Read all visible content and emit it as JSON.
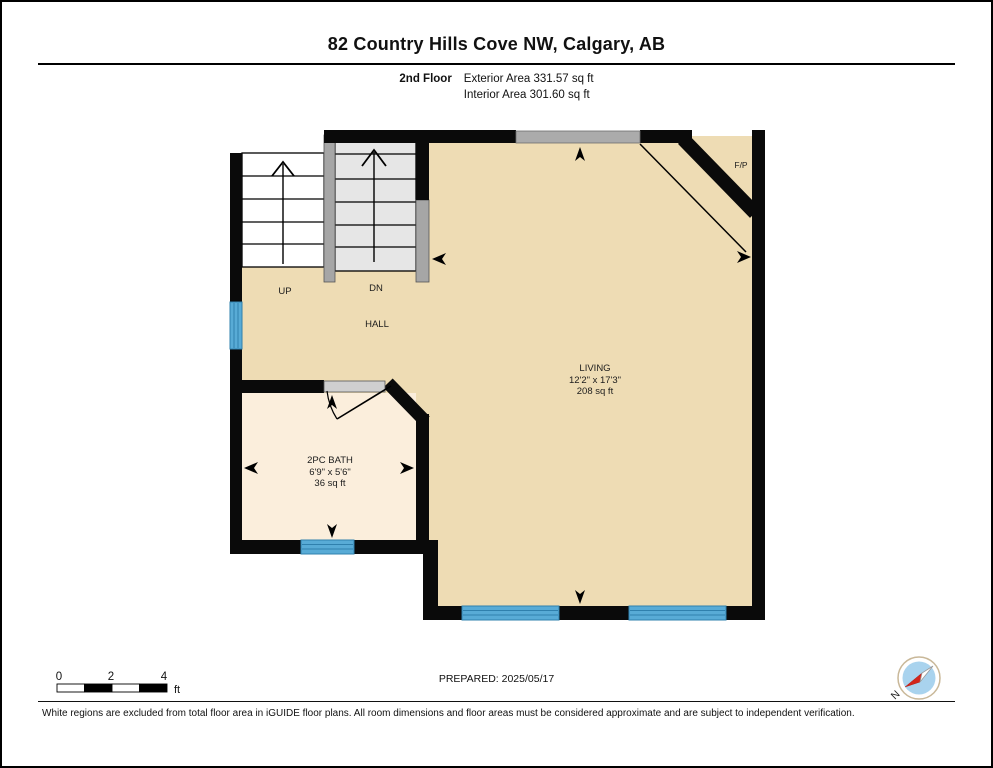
{
  "header": {
    "title": "82 Country Hills Cove NW, Calgary, AB",
    "floor_label": "2nd Floor",
    "exterior_area": "Exterior Area 331.57 sq ft",
    "interior_area": "Interior Area 301.60 sq ft"
  },
  "plan": {
    "labels": {
      "stairs_up": "UP",
      "stairs_down": "DN",
      "hall": "HALL",
      "fireplace": "F/P",
      "living": {
        "name": "LIVING",
        "dimensions": "12'2\" x 17'3\"",
        "area": "208 sq ft"
      },
      "bath": {
        "name": "2PC BATH",
        "dimensions": "6'9\" x 5'6\"",
        "area": "36 sq ft"
      }
    },
    "colors": {
      "floor": "#EEDCB4",
      "bath_floor": "#FBEEDC",
      "stair_tread": "#E6E6E6",
      "railing": "#A6A6A6",
      "wall": "#0A0A0A",
      "window": "#58ABD6",
      "window_stripe": "#2F80AD"
    }
  },
  "scale_bar": {
    "ticks": [
      "0",
      "2",
      "4"
    ],
    "unit": "ft"
  },
  "footer": {
    "prepared_label": "PREPARED: 2025/05/17",
    "disclaimer": "White regions are excluded from total floor area in iGUIDE floor plans. All room dimensions and floor areas must be considered approximate and are subject to independent verification.",
    "compass_north": "N",
    "compass_colors": {
      "disc": "#A9D3EE",
      "needle_red": "#D3261C"
    }
  }
}
